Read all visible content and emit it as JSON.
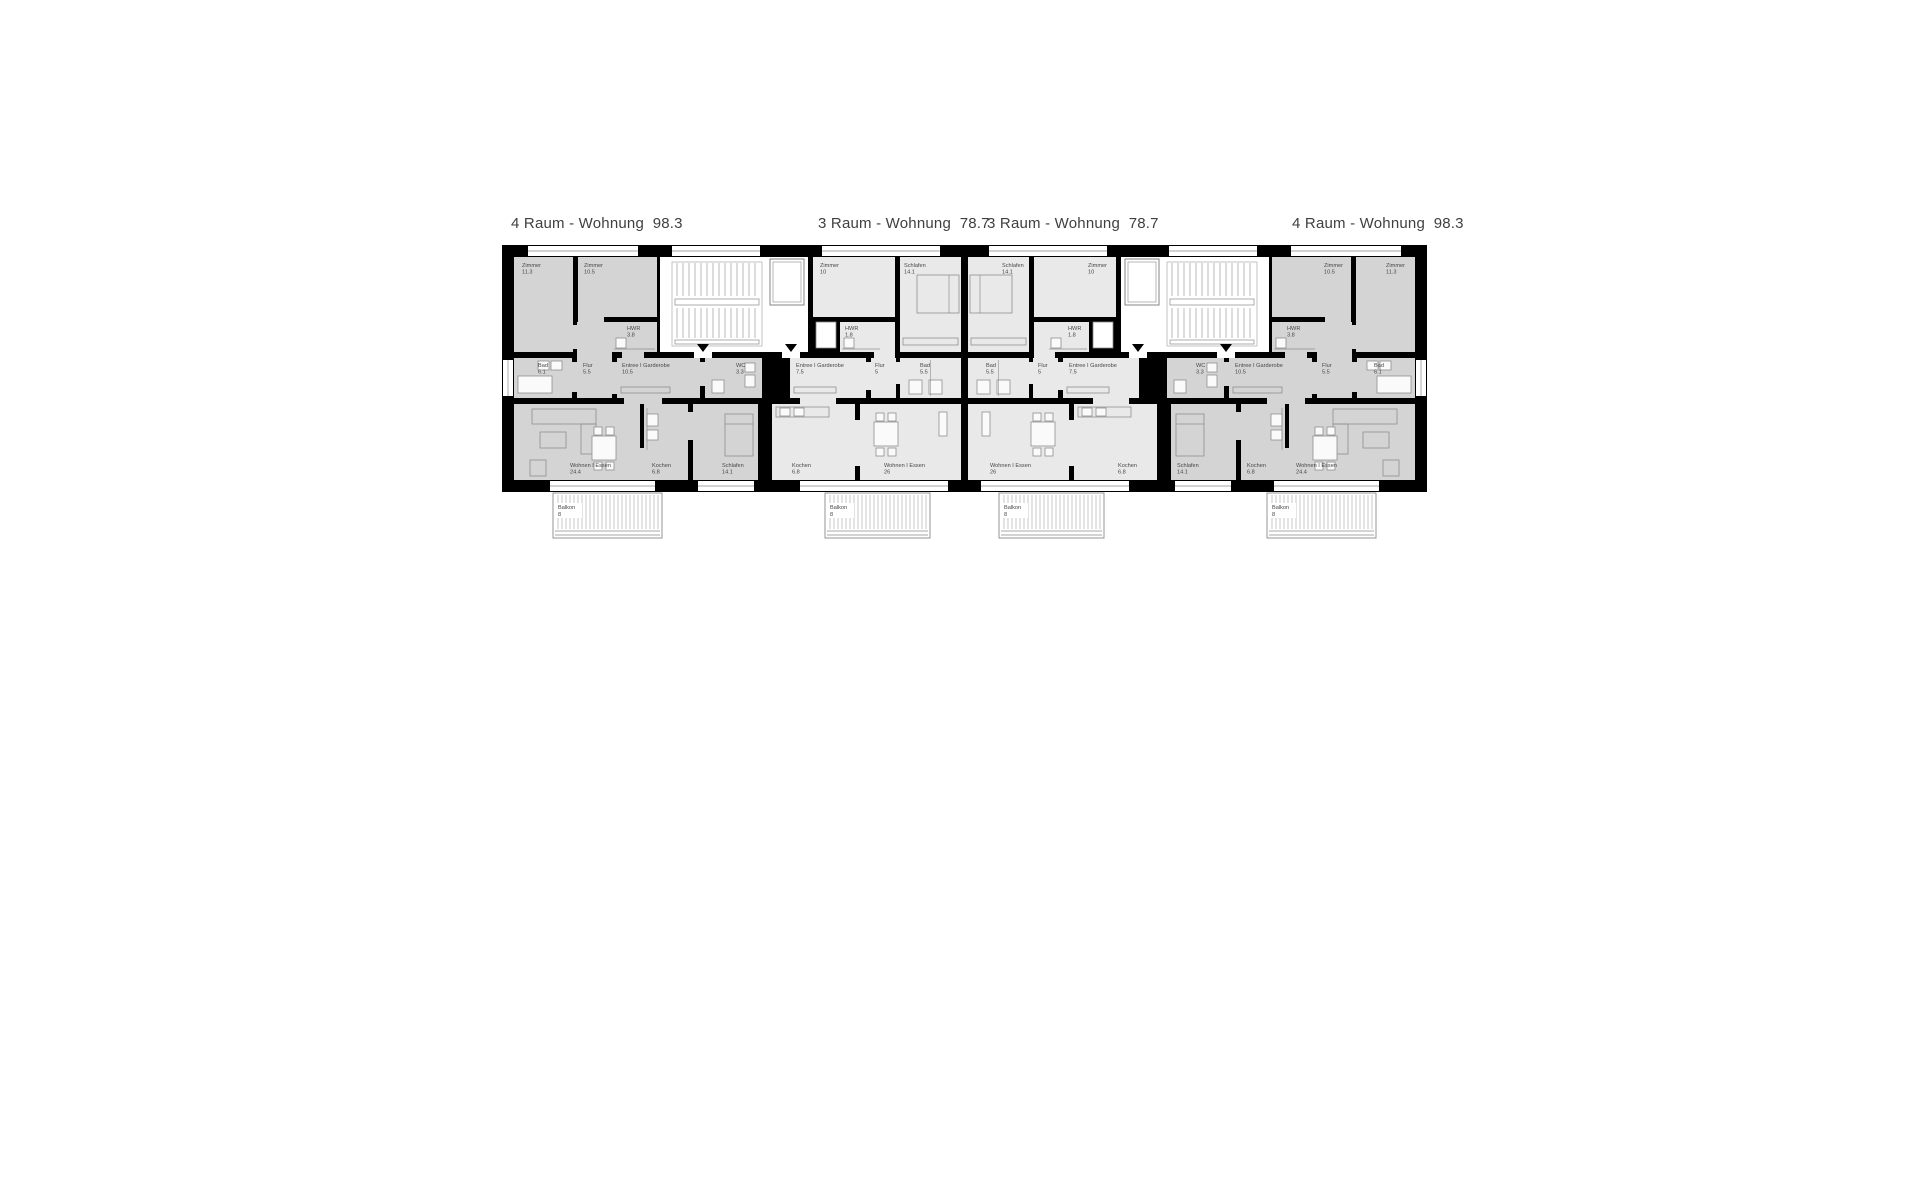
{
  "colors": {
    "wall": "#000000",
    "apt_4raum_fill": "#d4d4d4",
    "apt_3raum_fill": "#e9e9e9",
    "stair_fill": "#ffffff",
    "furniture_stroke": "#8f8f8f",
    "label_text": "#474747",
    "title_text": "#3f3f3f",
    "window_line": "#888888",
    "balcony_line": "#8a8a8a"
  },
  "plan": {
    "building": {
      "x": 502,
      "y": 245,
      "w": 925,
      "h": 247
    },
    "apartments": [
      {
        "id": "apartment-1",
        "title": "4 Raum - Wohnung  98.3",
        "title_x": 511,
        "fill": "#d4d4d4",
        "rooms": [
          {
            "name": "Zimmer",
            "area": "11.3",
            "x": 514,
            "y": 257,
            "w": 59,
            "h": 95,
            "lx": 522,
            "ly": 262,
            "furn": "none"
          },
          {
            "name": "Zimmer",
            "area": "10.5",
            "x": 578,
            "y": 257,
            "w": 79,
            "h": 60,
            "lx": 584,
            "ly": 262,
            "furn": "none"
          },
          {
            "name": "HWR",
            "area": "3.8",
            "x": 612,
            "y": 322,
            "w": 45,
            "h": 30,
            "lx": 627,
            "ly": 325,
            "furn": "hwr"
          },
          {
            "name": "Bad",
            "area": "6.1",
            "x": 514,
            "y": 358,
            "w": 58,
            "h": 40,
            "lx": 538,
            "ly": 362,
            "furn": "bath-a"
          },
          {
            "name": "Flur",
            "area": "5.5",
            "x": 577,
            "y": 322,
            "w": 35,
            "h": 76,
            "lx": 583,
            "ly": 362,
            "furn": "none"
          },
          {
            "name": "Entree I Garderobe",
            "area": "10.5",
            "x": 617,
            "y": 358,
            "w": 83,
            "h": 40,
            "lx": 622,
            "ly": 362,
            "furn": "wardrobe"
          },
          {
            "name": "WC",
            "area": "3.3",
            "x": 705,
            "y": 358,
            "w": 57,
            "h": 40,
            "lx": 736,
            "ly": 362,
            "furn": "wc"
          },
          {
            "name": "Wohnen I Essen",
            "area": "24.4",
            "x": 514,
            "y": 404,
            "w": 126,
            "h": 76,
            "lx": 570,
            "ly": 462,
            "furn": "living-w"
          },
          {
            "name": "Kochen",
            "area": "6.8",
            "x": 644,
            "y": 404,
            "w": 44,
            "h": 76,
            "lx": 652,
            "ly": 462,
            "furn": "kitchen-w"
          },
          {
            "name": "Schlafen",
            "area": "14.1",
            "x": 693,
            "y": 404,
            "w": 65,
            "h": 76,
            "lx": 722,
            "ly": 462,
            "furn": "bed-v-e"
          }
        ]
      },
      {
        "id": "apartment-2",
        "title": "3 Raum - Wohnung  78.7",
        "title_x": 818,
        "fill": "#e9e9e9",
        "rooms": [
          {
            "name": "Zimmer",
            "area": "10",
            "x": 813,
            "y": 257,
            "w": 82,
            "h": 60,
            "lx": 820,
            "ly": 262,
            "furn": "none"
          },
          {
            "name": "Schlafen",
            "area": "14.1",
            "x": 900,
            "y": 257,
            "w": 61,
            "h": 95,
            "lx": 904,
            "ly": 262,
            "furn": "schlafen-e"
          },
          {
            "name": "HWR",
            "area": "1.8",
            "x": 840,
            "y": 322,
            "w": 42,
            "h": 30,
            "lx": 845,
            "ly": 325,
            "furn": "hwr"
          },
          {
            "name": "Entree I Garderobe",
            "area": "7.5",
            "x": 790,
            "y": 358,
            "w": 76,
            "h": 40,
            "lx": 796,
            "ly": 362,
            "furn": "wardrobe"
          },
          {
            "name": "Flur",
            "area": "5",
            "x": 871,
            "y": 358,
            "w": 25,
            "h": 40,
            "lx": 875,
            "ly": 362,
            "furn": "none"
          },
          {
            "name": "Bad",
            "area": "5.5",
            "x": 900,
            "y": 358,
            "w": 61,
            "h": 40,
            "lx": 920,
            "ly": 362,
            "furn": "bath-s"
          },
          {
            "name": "Kochen",
            "area": "6.8",
            "x": 772,
            "y": 404,
            "w": 83,
            "h": 76,
            "lx": 792,
            "ly": 462,
            "furn": "kitchen-n"
          },
          {
            "name": "Wohnen I Essen",
            "area": "26",
            "x": 860,
            "y": 404,
            "w": 101,
            "h": 76,
            "lx": 884,
            "ly": 462,
            "furn": "living-c2"
          }
        ]
      },
      {
        "id": "apartment-3",
        "title": "3 Raum - Wohnung  78.7",
        "title_x": 987,
        "fill": "#e9e9e9",
        "rooms": [
          {
            "name": "Schlafen",
            "area": "14.1",
            "x": 968,
            "y": 257,
            "w": 61,
            "h": 95,
            "lx": 1002,
            "ly": 262,
            "furn": "schlafen-w"
          },
          {
            "name": "Zimmer",
            "area": "10",
            "x": 1034,
            "y": 257,
            "w": 82,
            "h": 60,
            "lx": 1088,
            "ly": 262,
            "furn": "none"
          },
          {
            "name": "HWR",
            "area": "1.8",
            "x": 1047,
            "y": 322,
            "w": 42,
            "h": 30,
            "lx": 1068,
            "ly": 325,
            "furn": "hwr"
          },
          {
            "name": "Bad",
            "area": "5.5",
            "x": 968,
            "y": 358,
            "w": 61,
            "h": 40,
            "lx": 986,
            "ly": 362,
            "furn": "bath-s"
          },
          {
            "name": "Flur",
            "area": "5",
            "x": 1033,
            "y": 358,
            "w": 25,
            "h": 40,
            "lx": 1038,
            "ly": 362,
            "furn": "none"
          },
          {
            "name": "Entree I Garderobe",
            "area": "7.5",
            "x": 1063,
            "y": 358,
            "w": 76,
            "h": 40,
            "lx": 1069,
            "ly": 362,
            "furn": "wardrobe"
          },
          {
            "name": "Wohnen I Essen",
            "area": "26",
            "x": 968,
            "y": 404,
            "w": 101,
            "h": 76,
            "lx": 990,
            "ly": 462,
            "furn": "living-c3"
          },
          {
            "name": "Kochen",
            "area": "6.8",
            "x": 1074,
            "y": 404,
            "w": 83,
            "h": 76,
            "lx": 1118,
            "ly": 462,
            "furn": "kitchen-n"
          }
        ]
      },
      {
        "id": "apartment-4",
        "title": "4 Raum - Wohnung  98.3",
        "title_x": 1292,
        "fill": "#d4d4d4",
        "rooms": [
          {
            "name": "Zimmer",
            "area": "10.5",
            "x": 1272,
            "y": 257,
            "w": 79,
            "h": 60,
            "lx": 1324,
            "ly": 262,
            "furn": "none"
          },
          {
            "name": "Zimmer",
            "area": "11.3",
            "x": 1356,
            "y": 257,
            "w": 59,
            "h": 95,
            "lx": 1386,
            "ly": 262,
            "furn": "none"
          },
          {
            "name": "HWR",
            "area": "3.8",
            "x": 1272,
            "y": 322,
            "w": 45,
            "h": 30,
            "lx": 1287,
            "ly": 325,
            "furn": "hwr"
          },
          {
            "name": "WC",
            "area": "3.3",
            "x": 1167,
            "y": 358,
            "w": 57,
            "h": 40,
            "lx": 1196,
            "ly": 362,
            "furn": "wc"
          },
          {
            "name": "Entree I Garderobe",
            "area": "10.5",
            "x": 1229,
            "y": 358,
            "w": 83,
            "h": 40,
            "lx": 1235,
            "ly": 362,
            "furn": "wardrobe"
          },
          {
            "name": "Flur",
            "area": "5.5",
            "x": 1317,
            "y": 322,
            "w": 35,
            "h": 76,
            "lx": 1322,
            "ly": 362,
            "furn": "none"
          },
          {
            "name": "Bad",
            "area": "6.1",
            "x": 1357,
            "y": 358,
            "w": 58,
            "h": 40,
            "lx": 1374,
            "ly": 362,
            "furn": "bath-a2"
          },
          {
            "name": "Schlafen",
            "area": "14.1",
            "x": 1171,
            "y": 404,
            "w": 65,
            "h": 76,
            "lx": 1177,
            "ly": 462,
            "furn": "bed-v-w"
          },
          {
            "name": "Kochen",
            "area": "6.8",
            "x": 1241,
            "y": 404,
            "w": 44,
            "h": 76,
            "lx": 1247,
            "ly": 462,
            "furn": "kitchen-e"
          },
          {
            "name": "Wohnen I Essen",
            "area": "24.4",
            "x": 1289,
            "y": 404,
            "w": 126,
            "h": 76,
            "lx": 1296,
            "ly": 462,
            "furn": "living-e"
          }
        ]
      }
    ],
    "stairwells": [
      {
        "id": "stairwell-1",
        "x": 660,
        "y": 257,
        "w": 148,
        "h": 95,
        "stairs": {
          "x": 672,
          "y": 262,
          "w": 90,
          "h": 84
        },
        "shaft": {
          "x": 770,
          "y": 259,
          "w": 34,
          "h": 46
        },
        "arrows": [
          [
            703,
            349
          ],
          [
            791,
            349
          ]
        ],
        "gaps": [
          [
            694,
            352,
            18
          ],
          [
            782,
            352,
            18
          ]
        ]
      },
      {
        "id": "stairwell-2",
        "x": 1121,
        "y": 257,
        "w": 148,
        "h": 95,
        "stairs": {
          "x": 1167,
          "y": 262,
          "w": 90,
          "h": 84
        },
        "shaft": {
          "x": 1125,
          "y": 259,
          "w": 34,
          "h": 46
        },
        "arrows": [
          [
            1138,
            349
          ],
          [
            1226,
            349
          ]
        ],
        "gaps": [
          [
            1129,
            352,
            18
          ],
          [
            1217,
            352,
            18
          ]
        ]
      }
    ],
    "ducts": [
      {
        "x": 816,
        "y": 322,
        "w": 20,
        "h": 26
      },
      {
        "x": 1093,
        "y": 322,
        "w": 20,
        "h": 26
      }
    ],
    "openings": [
      {
        "x": 572,
        "y": 362,
        "w": 5,
        "h": 30,
        "fill": "#d4d4d4"
      },
      {
        "x": 612,
        "y": 362,
        "w": 5,
        "h": 32,
        "fill": "#d4d4d4"
      },
      {
        "x": 573,
        "y": 325,
        "w": 5,
        "h": 24,
        "fill": "#d4d4d4"
      },
      {
        "x": 578,
        "y": 317,
        "w": 26,
        "h": 5,
        "fill": "#d4d4d4"
      },
      {
        "x": 700,
        "y": 362,
        "w": 5,
        "h": 24,
        "fill": "#d4d4d4"
      },
      {
        "x": 622,
        "y": 352,
        "w": 22,
        "h": 6,
        "fill": "#d4d4d4"
      },
      {
        "x": 624,
        "y": 398,
        "w": 38,
        "h": 6,
        "fill": "#d4d4d4"
      },
      {
        "x": 640,
        "y": 448,
        "w": 4,
        "h": 32,
        "fill": "#d4d4d4"
      },
      {
        "x": 688,
        "y": 412,
        "w": 5,
        "h": 28,
        "fill": "#d4d4d4"
      },
      {
        "x": 866,
        "y": 362,
        "w": 5,
        "h": 28,
        "fill": "#e9e9e9"
      },
      {
        "x": 896,
        "y": 362,
        "w": 4,
        "h": 22,
        "fill": "#e9e9e9"
      },
      {
        "x": 874,
        "y": 352,
        "w": 18,
        "h": 6,
        "fill": "#e9e9e9"
      },
      {
        "x": 882,
        "y": 322,
        "w": 13,
        "h": 36,
        "fill": "#e9e9e9"
      },
      {
        "x": 800,
        "y": 398,
        "w": 36,
        "h": 6,
        "fill": "#e9e9e9"
      },
      {
        "x": 855,
        "y": 420,
        "w": 5,
        "h": 46,
        "fill": "#e9e9e9"
      },
      {
        "x": 1058,
        "y": 362,
        "w": 5,
        "h": 28,
        "fill": "#e9e9e9"
      },
      {
        "x": 1029,
        "y": 362,
        "w": 4,
        "h": 22,
        "fill": "#e9e9e9"
      },
      {
        "x": 1037,
        "y": 352,
        "w": 18,
        "h": 6,
        "fill": "#e9e9e9"
      },
      {
        "x": 1034,
        "y": 322,
        "w": 13,
        "h": 36,
        "fill": "#e9e9e9"
      },
      {
        "x": 1093,
        "y": 398,
        "w": 36,
        "h": 6,
        "fill": "#e9e9e9"
      },
      {
        "x": 1069,
        "y": 420,
        "w": 5,
        "h": 46,
        "fill": "#e9e9e9"
      },
      {
        "x": 1352,
        "y": 362,
        "w": 5,
        "h": 30,
        "fill": "#d4d4d4"
      },
      {
        "x": 1312,
        "y": 362,
        "w": 5,
        "h": 32,
        "fill": "#d4d4d4"
      },
      {
        "x": 1351,
        "y": 325,
        "w": 5,
        "h": 24,
        "fill": "#d4d4d4"
      },
      {
        "x": 1325,
        "y": 317,
        "w": 26,
        "h": 5,
        "fill": "#d4d4d4"
      },
      {
        "x": 1224,
        "y": 362,
        "w": 5,
        "h": 24,
        "fill": "#d4d4d4"
      },
      {
        "x": 1285,
        "y": 352,
        "w": 22,
        "h": 6,
        "fill": "#d4d4d4"
      },
      {
        "x": 1267,
        "y": 398,
        "w": 38,
        "h": 6,
        "fill": "#d4d4d4"
      },
      {
        "x": 1285,
        "y": 448,
        "w": 4,
        "h": 32,
        "fill": "#d4d4d4"
      },
      {
        "x": 1236,
        "y": 412,
        "w": 5,
        "h": 28,
        "fill": "#d4d4d4"
      }
    ],
    "windows": {
      "top": [
        [
          528,
          110
        ],
        [
          672,
          88
        ],
        [
          822,
          118
        ],
        [
          989,
          118
        ],
        [
          1169,
          88
        ],
        [
          1291,
          110
        ]
      ],
      "bottom": [
        [
          550,
          105
        ],
        [
          698,
          56
        ],
        [
          800,
          148
        ],
        [
          981,
          148
        ],
        [
          1175,
          56
        ],
        [
          1274,
          105
        ]
      ],
      "left": {
        "x": 503,
        "y": 360,
        "w": 10,
        "h": 36
      },
      "right": {
        "x": 1416,
        "y": 360,
        "w": 10,
        "h": 36
      }
    },
    "balconies": [
      {
        "name": "Balkon",
        "area": "8",
        "x": 553,
        "y": 493,
        "w": 109,
        "h": 45
      },
      {
        "name": "Balkon",
        "area": "8",
        "x": 825,
        "y": 493,
        "w": 105,
        "h": 45
      },
      {
        "name": "Balkon",
        "area": "8",
        "x": 999,
        "y": 493,
        "w": 105,
        "h": 45
      },
      {
        "name": "Balkon",
        "area": "8",
        "x": 1267,
        "y": 493,
        "w": 109,
        "h": 45
      }
    ]
  }
}
